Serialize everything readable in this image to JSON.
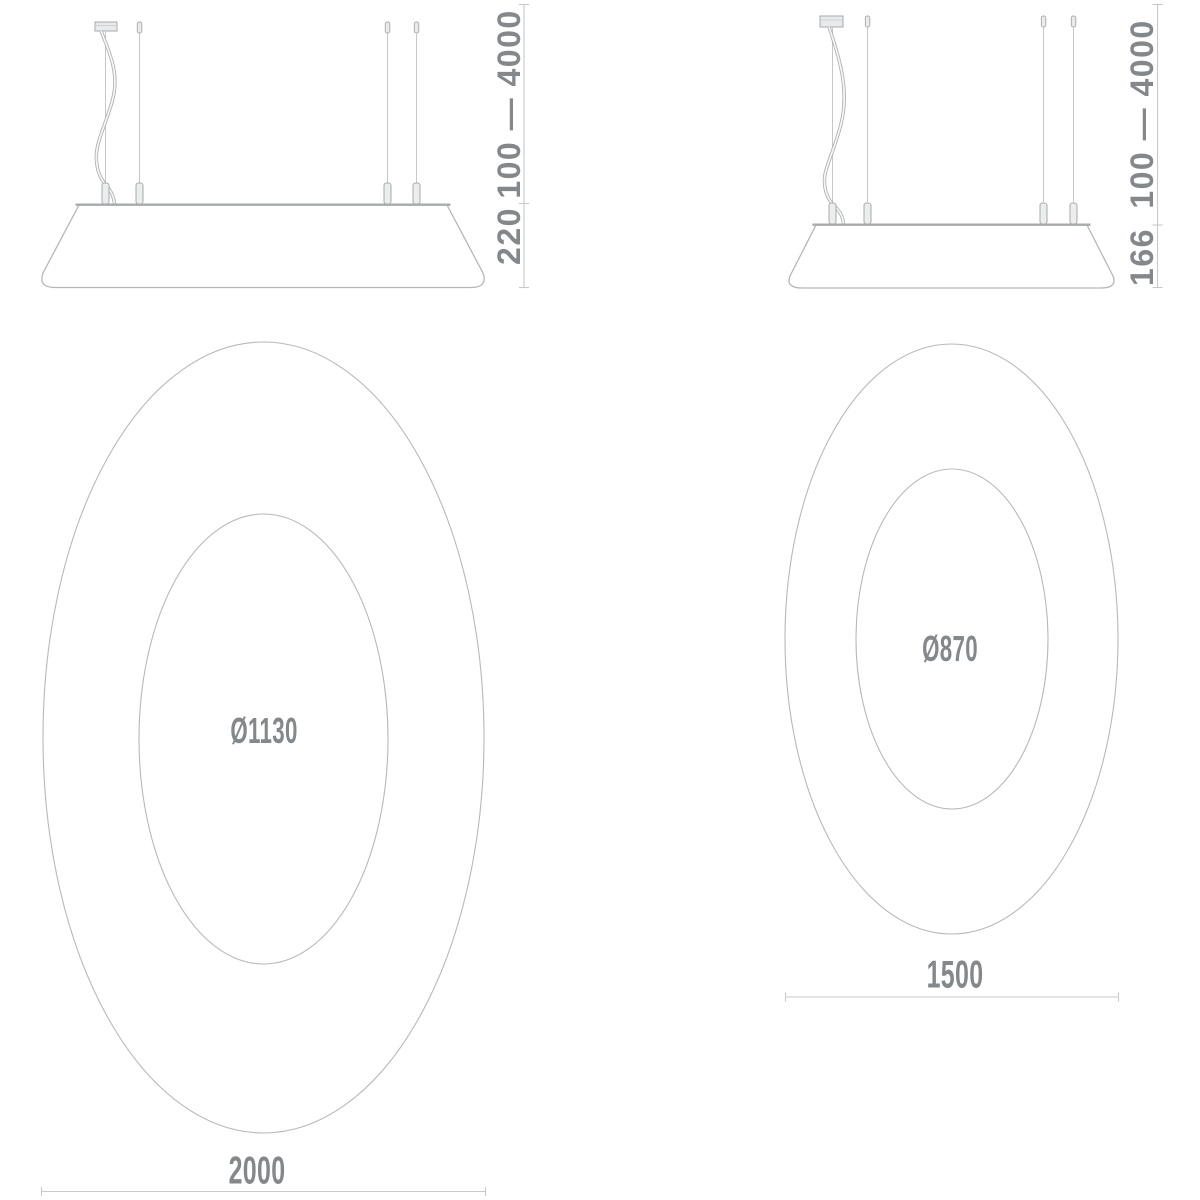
{
  "fixtures": {
    "large": {
      "side_view": {
        "suspension_range": "100 — 4000",
        "shade_height": "220"
      },
      "top_view": {
        "inner_diameter": "Ø1130",
        "outer_diameter": "2000"
      }
    },
    "small": {
      "side_view": {
        "suspension_range": "100 — 4000",
        "shade_height": "166"
      },
      "top_view": {
        "inner_diameter": "Ø870",
        "outer_diameter": "1500"
      }
    }
  },
  "colors": {
    "dimension_text": "#85888b",
    "drawing_line": "#b4b7b9",
    "drawing_line_dark": "#a8abae",
    "dimension_line": "#c7c9cb",
    "fill_light": "#e9eaeb",
    "background": "#ffffff"
  }
}
